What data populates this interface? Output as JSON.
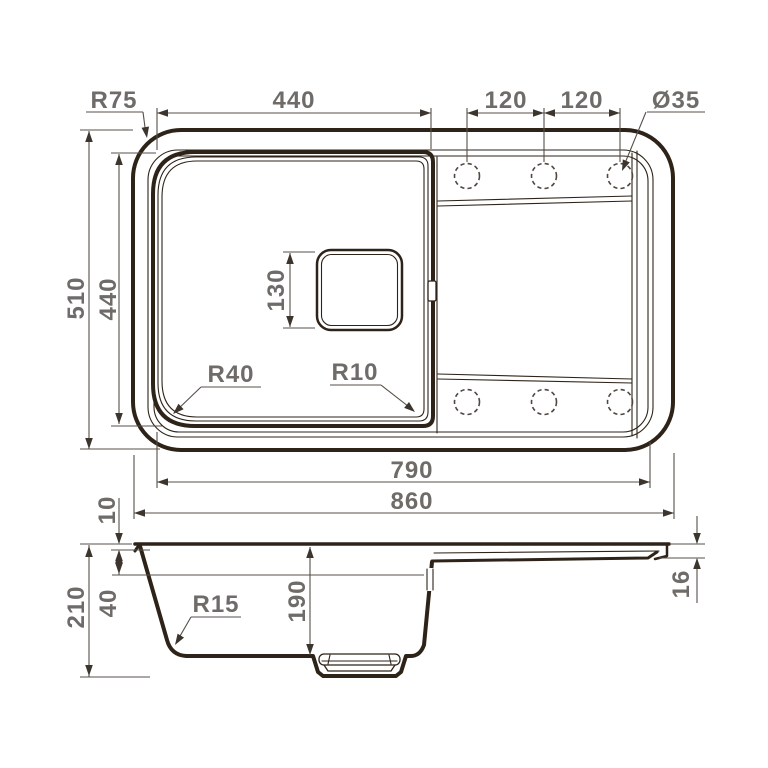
{
  "title": "Kitchen sink technical drawing",
  "views": {
    "top": {
      "dims": {
        "corner_radius": "R75",
        "bowl_width": "440",
        "tap_spacing_left": "120",
        "tap_spacing_right": "120",
        "tap_hole_diameter": "Ø35",
        "overall_depth": "510",
        "bowl_depth": "440",
        "drain_size": "130",
        "bowl_corner_radius_left": "R40",
        "bowl_corner_radius_right": "R10",
        "inner_width": "790",
        "overall_width": "860"
      }
    },
    "section": {
      "dims": {
        "rim_height": "10",
        "overall_height": "210",
        "ledge_depth": "40",
        "bottom_corner_radius": "R15",
        "bowl_inner_depth": "190",
        "edge_thickness": "16"
      }
    }
  },
  "colors": {
    "outline": "#2e2318",
    "dimension_line": "#564f48",
    "label_text": "#6f6b68",
    "background": "#ffffff"
  }
}
